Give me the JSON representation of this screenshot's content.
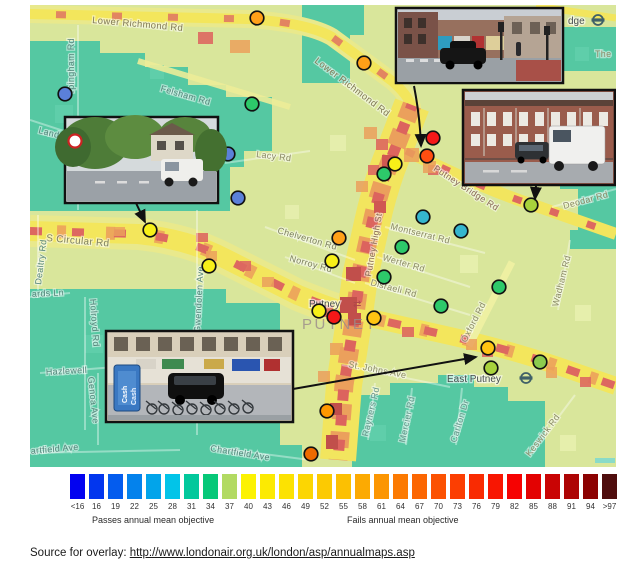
{
  "map": {
    "area_label": "PUTNEY",
    "road_labels": [
      {
        "t": "Lower Richmond Rd",
        "x": 62,
        "y": 18,
        "r": 5,
        "s": 9.5,
        "c": "#827a56"
      },
      {
        "t": "Lower Richmond Rd",
        "x": 284,
        "y": 57,
        "r": 37,
        "s": 9.5,
        "c": "#827a56"
      },
      {
        "t": "rpingham Rd",
        "x": 44,
        "y": 88,
        "r": -90,
        "s": 9,
        "c": "#56857b"
      },
      {
        "t": "Felsham Rd",
        "x": 130,
        "y": 86,
        "r": 16,
        "s": 9,
        "c": "#56857b"
      },
      {
        "t": "Lacy Rd",
        "x": 226,
        "y": 152,
        "r": 7,
        "s": 9,
        "c": "#8b8a66"
      },
      {
        "t": "Land",
        "x": 8,
        "y": 128,
        "r": 14,
        "s": 9,
        "c": "#56857b"
      },
      {
        "t": "S Circular Rd",
        "x": 16,
        "y": 236,
        "r": 5,
        "s": 10,
        "c": "#7d7f5e"
      },
      {
        "t": "Dealtry Rd",
        "x": 11,
        "y": 280,
        "r": -83,
        "s": 9,
        "c": "#56857b"
      },
      {
        "t": "ards Ln",
        "x": 2,
        "y": 292,
        "r": -3,
        "s": 9,
        "c": "#56857b"
      },
      {
        "t": "Holroyd Rd",
        "x": 60,
        "y": 294,
        "r": 86,
        "s": 9,
        "c": "#56857b"
      },
      {
        "t": "Hazlewell",
        "x": 16,
        "y": 370,
        "r": -3,
        "s": 9,
        "c": "#56857b"
      },
      {
        "t": "Genoa Ave",
        "x": 58,
        "y": 372,
        "r": 84,
        "s": 9,
        "c": "#56857b"
      },
      {
        "t": "artfield Ave",
        "x": 1,
        "y": 449,
        "r": -5,
        "s": 9,
        "c": "#56857b"
      },
      {
        "t": "Chartfield Ave",
        "x": 180,
        "y": 446,
        "r": 9,
        "s": 9,
        "c": "#56857b"
      },
      {
        "t": "Gwendolen Ave",
        "x": 170,
        "y": 328,
        "r": -87,
        "s": 9,
        "c": "#56857b"
      },
      {
        "t": "Chelverton Rd",
        "x": 247,
        "y": 228,
        "r": 16,
        "s": 9,
        "c": "#7d8060"
      },
      {
        "t": "Norroy Rd",
        "x": 259,
        "y": 256,
        "r": 15,
        "s": 9,
        "c": "#7d8060"
      },
      {
        "t": "Putney High St",
        "x": 341,
        "y": 272,
        "r": -80,
        "s": 9,
        "c": "#8a6a58"
      },
      {
        "t": "Montserrat Rd",
        "x": 360,
        "y": 224,
        "r": 14,
        "s": 9,
        "c": "#8b8a66"
      },
      {
        "t": "Werter Rd",
        "x": 352,
        "y": 255,
        "r": 16,
        "s": 9,
        "c": "#8b8a66"
      },
      {
        "t": "Disraeli Rd",
        "x": 340,
        "y": 280,
        "r": 15,
        "s": 9,
        "c": "#8b8a66"
      },
      {
        "t": "St. Johns Ave",
        "x": 318,
        "y": 362,
        "r": 11,
        "s": 9,
        "c": "#8b8a66"
      },
      {
        "t": "Oxford Rd",
        "x": 436,
        "y": 338,
        "r": -63,
        "s": 9,
        "c": "#8b8a66"
      },
      {
        "t": "Rayners Rd",
        "x": 338,
        "y": 432,
        "r": -77,
        "s": 9,
        "c": "#66958a"
      },
      {
        "t": "Mercier Rd",
        "x": 375,
        "y": 438,
        "r": -78,
        "s": 9,
        "c": "#66958a"
      },
      {
        "t": "Carlton Dr",
        "x": 426,
        "y": 438,
        "r": -73,
        "s": 9,
        "c": "#66958a"
      },
      {
        "t": "Keswick Rd",
        "x": 500,
        "y": 452,
        "r": -53,
        "s": 9,
        "c": "#8b8a66"
      },
      {
        "t": "Wadham Rd",
        "x": 528,
        "y": 302,
        "r": -76,
        "s": 9,
        "c": "#8b8a66"
      },
      {
        "t": "Deodar Rd",
        "x": 534,
        "y": 204,
        "r": -15,
        "s": 9,
        "c": "#8b8a66"
      },
      {
        "t": "The",
        "x": 565,
        "y": 52,
        "r": 0,
        "s": 9,
        "c": "#8b8a66"
      },
      {
        "t": "Putney Bridge Rd",
        "x": 403,
        "y": 165,
        "r": 33,
        "s": 9,
        "c": "#8a6a58"
      }
    ],
    "stations": [
      {
        "name": "Putney",
        "x": 279,
        "y": 302,
        "sym": "rail",
        "sx": 323,
        "sy": 302
      },
      {
        "name": "East Putney",
        "x": 417,
        "y": 377,
        "sym": "roundel",
        "sx": 496,
        "sy": 373
      },
      {
        "name": "dge",
        "x": 538,
        "y": 19,
        "sym": "roundel",
        "sx": 568,
        "sy": 15
      }
    ],
    "dots": [
      {
        "x": 227,
        "y": 13,
        "c": "#FFA018"
      },
      {
        "x": 35,
        "y": 89,
        "c": "#5B80D9"
      },
      {
        "x": 222,
        "y": 99,
        "c": "#2DC96A"
      },
      {
        "x": 334,
        "y": 58,
        "c": "#FFA018"
      },
      {
        "x": 403,
        "y": 133,
        "c": "#F51818"
      },
      {
        "x": 397,
        "y": 151,
        "c": "#FF4E11"
      },
      {
        "x": 365,
        "y": 159,
        "c": "#F7F018"
      },
      {
        "x": 354,
        "y": 169,
        "c": "#2DC96A"
      },
      {
        "x": 501,
        "y": 200,
        "c": "#A8D23C"
      },
      {
        "x": 393,
        "y": 212,
        "c": "#35B6CE"
      },
      {
        "x": 431,
        "y": 226,
        "c": "#35B6CE"
      },
      {
        "x": 198,
        "y": 149,
        "c": "#5B80D9"
      },
      {
        "x": 208,
        "y": 193,
        "c": "#5B80D9"
      },
      {
        "x": 120,
        "y": 225,
        "c": "#F7F018"
      },
      {
        "x": 179,
        "y": 261,
        "c": "#F7F018"
      },
      {
        "x": 309,
        "y": 233,
        "c": "#FFA018"
      },
      {
        "x": 302,
        "y": 256,
        "c": "#F7F018"
      },
      {
        "x": 372,
        "y": 242,
        "c": "#2DC96A"
      },
      {
        "x": 354,
        "y": 272,
        "c": "#2DC96A"
      },
      {
        "x": 469,
        "y": 282,
        "c": "#2DC96A"
      },
      {
        "x": 289,
        "y": 306,
        "c": "#F7F018"
      },
      {
        "x": 304,
        "y": 312,
        "c": "#F51818"
      },
      {
        "x": 344,
        "y": 313,
        "c": "#FFC412"
      },
      {
        "x": 411,
        "y": 301,
        "c": "#2DC96A"
      },
      {
        "x": 458,
        "y": 343,
        "c": "#FFC412"
      },
      {
        "x": 461,
        "y": 363,
        "c": "#A8D23C"
      },
      {
        "x": 510,
        "y": 357,
        "c": "#8CCB4E"
      },
      {
        "x": 297,
        "y": 406,
        "c": "#FF9800"
      },
      {
        "x": 281,
        "y": 449,
        "c": "#EE6A00"
      }
    ],
    "arrows": [
      {
        "d": "M384,81 Q390,112 391,141"
      },
      {
        "d": "M506,181 L505,194"
      },
      {
        "d": "M106,198 L115,217"
      },
      {
        "d": "M263,384 L446,352"
      }
    ],
    "photos": [
      {
        "alt": "Putney High St crossing with black car"
      },
      {
        "alt": "Terraced houses on Putney Bridge Rd with white truck"
      },
      {
        "alt": "Leafy road junction with white van"
      },
      {
        "alt": "Putney shopping parade with parked bicycles",
        "sign_text": "Cash"
      }
    ]
  },
  "legend": {
    "stops": [
      {
        "v": "<16",
        "c": "#0202f0"
      },
      {
        "v": "16",
        "c": "#0236ee"
      },
      {
        "v": "19",
        "c": "#045cee"
      },
      {
        "v": "22",
        "c": "#0482ec"
      },
      {
        "v": "25",
        "c": "#02a4ea"
      },
      {
        "v": "28",
        "c": "#02c4e8"
      },
      {
        "v": "31",
        "c": "#02c89c"
      },
      {
        "v": "34",
        "c": "#06c878"
      },
      {
        "v": "37",
        "c": "#b2da62"
      },
      {
        "v": "40",
        "c": "#fcf202"
      },
      {
        "v": "43",
        "c": "#fcea02"
      },
      {
        "v": "46",
        "c": "#fce202"
      },
      {
        "v": "49",
        "c": "#fcd602"
      },
      {
        "v": "52",
        "c": "#fcca02"
      },
      {
        "v": "55",
        "c": "#fcc002"
      },
      {
        "v": "58",
        "c": "#fcaa02"
      },
      {
        "v": "61",
        "c": "#fc9602"
      },
      {
        "v": "64",
        "c": "#fc7a02"
      },
      {
        "v": "67",
        "c": "#fc6602"
      },
      {
        "v": "70",
        "c": "#fc5202"
      },
      {
        "v": "73",
        "c": "#fc3e02"
      },
      {
        "v": "76",
        "c": "#f92b02"
      },
      {
        "v": "79",
        "c": "#f81602"
      },
      {
        "v": "82",
        "c": "#f60202"
      },
      {
        "v": "85",
        "c": "#e30202"
      },
      {
        "v": "88",
        "c": "#c90404"
      },
      {
        "v": "91",
        "c": "#ad0404"
      },
      {
        "v": "94",
        "c": "#8c0202"
      },
      {
        "v": ">97",
        "c": "#4f0d0d"
      }
    ],
    "passes_label": "Passes annual mean objective",
    "fails_label": "Fails annual mean objective"
  },
  "source": {
    "prefix": "Source for overlay: ",
    "url": "http://www.londonair.org.uk/london/asp/annualmaps.asp"
  }
}
